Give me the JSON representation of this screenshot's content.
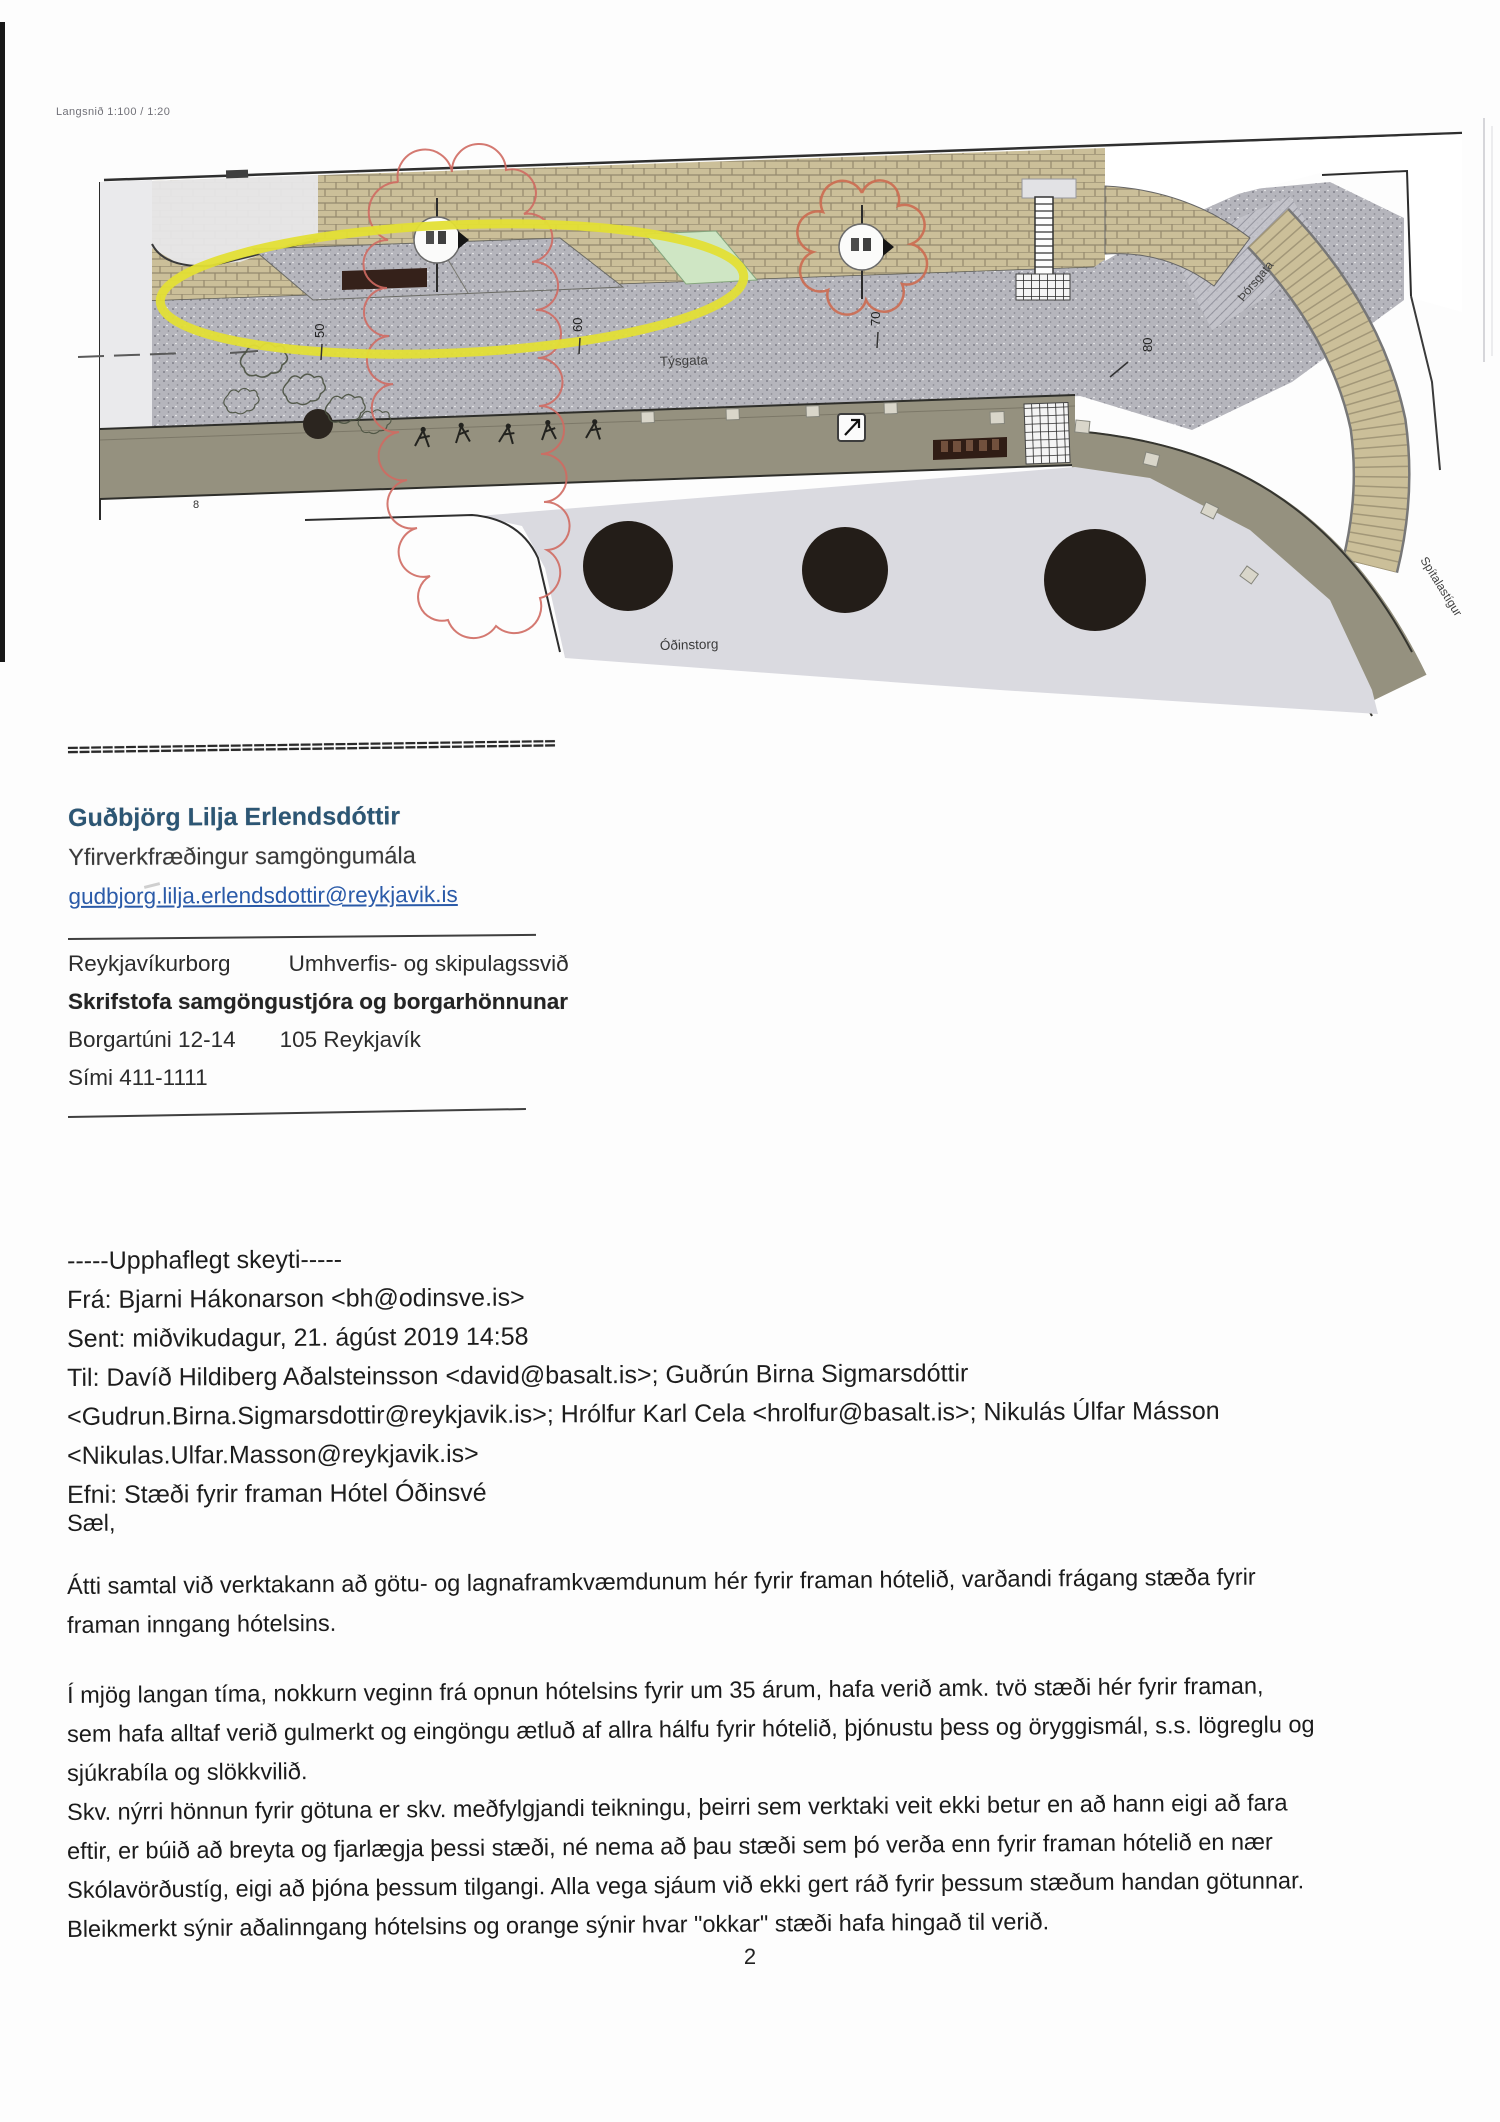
{
  "drawing": {
    "scale_label": "Langsnið 1:100 / 1:20",
    "labels": {
      "tysgata": "Týsgata",
      "odinstorg": "Óðinstorg",
      "thorsgata": "Þórsgata",
      "spitalastigur": "Spítalastígur"
    },
    "stations": [
      "50",
      "60",
      "70",
      "80"
    ],
    "station_small": "8",
    "colors": {
      "highlight_yellow": "#e3df35",
      "revision_red": "#cf6a62",
      "paver_tan": "#cbbf99",
      "plaza_gray": "#b5b5bc",
      "road_gray": "#95917f",
      "square_gray": "#dadae0",
      "marking_dark": "#35211a",
      "green_bed": "#cfe6c4"
    }
  },
  "separator": "==========================================",
  "signature": {
    "name": "Guðbjörg Lilja Erlendsdóttir",
    "title": "Yfirverkfræðingur samgöngumála",
    "email": "gudbjorg.lilja.erlendsdottir@reykjavik.is"
  },
  "organization": {
    "city": "Reykjavíkurborg",
    "division": "Umhverfis- og skipulagssvið",
    "office": "Skrifstofa samgöngustjóra og borgarhönnunar",
    "address": "Borgartúni 12-14",
    "postal": "105 Reykjavík",
    "phone": "Sími 411-1111"
  },
  "quote_header": {
    "divider": "-----Upphaflegt skeyti-----",
    "from": "Frá: Bjarni Hákonarson <bh@odinsve.is>",
    "sent": "Sent: miðvikudagur, 21. ágúst 2019 14:58",
    "to_lines": [
      "Til: Davíð Hildiberg Aðalsteinsson <david@basalt.is>; Guðrún Birna Sigmarsdóttir",
      "<Gudrun.Birna.Sigmarsdottir@reykjavik.is>; Hrólfur Karl Cela <hrolfur@basalt.is>; Nikulás Úlfar Másson",
      "<Nikulas.Ulfar.Masson@reykjavik.is>"
    ],
    "subject": "Efni: Stæði fyrir framan Hótel Óðinsvé"
  },
  "body": {
    "greeting": "Sæl,",
    "p1_lines": [
      "Átti samtal við verktakann að götu- og lagnaframkvæmdunum hér fyrir framan hótelið, varðandi frágang stæða fyrir",
      "framan inngang hótelsins."
    ],
    "p2_lines": [
      "Í mjög langan tíma, nokkurn veginn frá opnun hótelsins fyrir um 35 árum, hafa verið amk. tvö stæði hér fyrir framan,",
      "sem hafa alltaf verið gulmerkt og eingöngu ætluð af allra hálfu fyrir hótelið, þjónustu þess og öryggismál, s.s. lögreglu og",
      "sjúkrabíla og slökkvilið.",
      "Skv. nýrri hönnun fyrir götuna er skv. meðfylgjandi teikningu, þeirri sem verktaki veit ekki betur en að hann eigi að fara",
      "eftir, er búið að breyta og fjarlægja þessi stæði, né nema að þau stæði sem þó verða enn fyrir framan hótelið en nær",
      "Skólavörðustíg, eigi að þjóna þessum tilgangi. Alla vega sjáum við ekki gert ráð fyrir þessum stæðum handan götunnar.",
      "Bleikmerkt sýnir aðalinngang hótelsins og orange sýnir hvar \"okkar\" stæði hafa hingað til verið."
    ]
  },
  "page_number": "2"
}
